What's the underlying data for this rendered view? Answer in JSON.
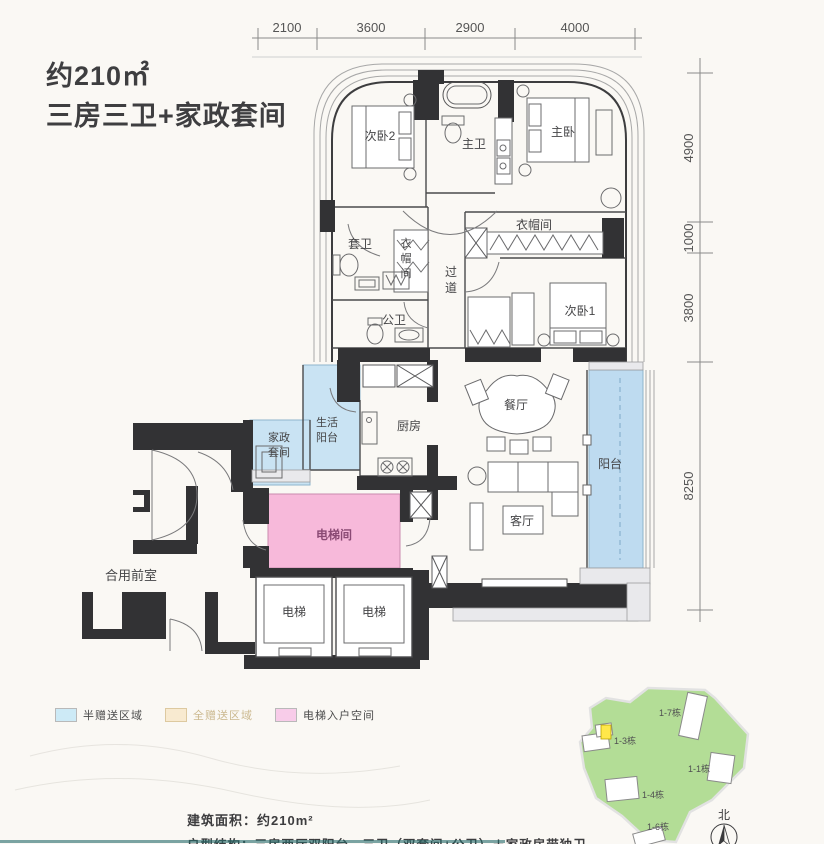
{
  "title": {
    "line1": "约210㎡",
    "line2": "三房三卫+家政套间"
  },
  "dimensions": {
    "top": [
      "2100",
      "3600",
      "2900",
      "4000"
    ],
    "right": [
      "4900",
      "1000",
      "3800",
      "8250"
    ]
  },
  "rooms": {
    "bedroom2": "次卧2",
    "master_bath": "主卫",
    "master_bedroom": "主卧",
    "suite_bath": "套卫",
    "cloak_left": [
      "衣",
      "帽",
      "间"
    ],
    "corridor": [
      "过",
      "道"
    ],
    "cloak_right": "衣帽间",
    "public_bath": "公卫",
    "bedroom1": "次卧1",
    "dining": "餐厅",
    "kitchen": "厨房",
    "living_balcony": [
      "生活",
      "阳台"
    ],
    "housekeeping": [
      "家政",
      "套间"
    ],
    "balcony": "阳台",
    "elevator_hall": "电梯间",
    "living": "客厅",
    "elevator1": "电梯",
    "elevator2": "电梯",
    "shared_front": "合用前室"
  },
  "legend": [
    {
      "label": "半赠送区域",
      "color": "#cdeaf6"
    },
    {
      "label": "全赠送区域",
      "color": "#f8ead0"
    },
    {
      "label": "电梯入户空间",
      "color": "#f8cce9"
    }
  ],
  "site_plan": {
    "buildings": [
      "1-7栋",
      "1-3栋",
      "1-1栋",
      "1-4栋",
      "1-6栋"
    ],
    "compass": "北"
  },
  "footer": {
    "line1": "建筑面积：约210m²",
    "line2": "户型结构：三房两厅双阳台，三卫（双套间+公卫）＋家政房带独卫"
  },
  "colors": {
    "wall": "#323234",
    "semi_gift": "#c9e3f3",
    "balcony_blue": "#bedbf0",
    "elevator_pink": "#f7b9da",
    "site_green": "#b3dd96",
    "highlight_yellow": "#ffe84a"
  }
}
